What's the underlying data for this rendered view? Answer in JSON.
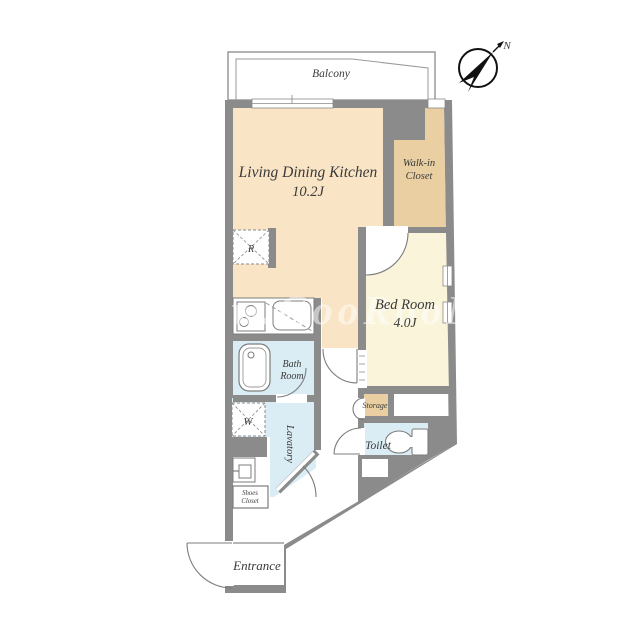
{
  "plan": {
    "compass": {
      "north_label": "N"
    },
    "balcony": {
      "label": "Balcony"
    },
    "rooms": {
      "ldk": {
        "label": "Living Dining Kitchen",
        "size": "10.2J"
      },
      "walk_in_closet": {
        "line1": "Walk-in",
        "line2": "Closet"
      },
      "bedroom": {
        "label": "Bed Room",
        "size": "4.0J"
      },
      "bath": {
        "line1": "Bath",
        "line2": "Room"
      },
      "lavatory": {
        "label": "Lavatory"
      },
      "toilet": {
        "label": "Toilet"
      },
      "storage": {
        "label": "Storage"
      },
      "shoes_closet": {
        "line1": "Shoes",
        "line2": "Closet"
      },
      "entrance": {
        "label": "Entrance"
      }
    },
    "markers": {
      "refrigerator": "R",
      "washing_machine": "W"
    },
    "watermark": "w.GooRooM",
    "colors": {
      "wall": "#8b8b8b",
      "ldk_floor": "#f9e5c6",
      "closet_floor": "#e9cfa1",
      "bedroom_floor": "#faf4da",
      "wet_area_floor": "#daedf4",
      "label_text": "#3a3a3a"
    }
  }
}
